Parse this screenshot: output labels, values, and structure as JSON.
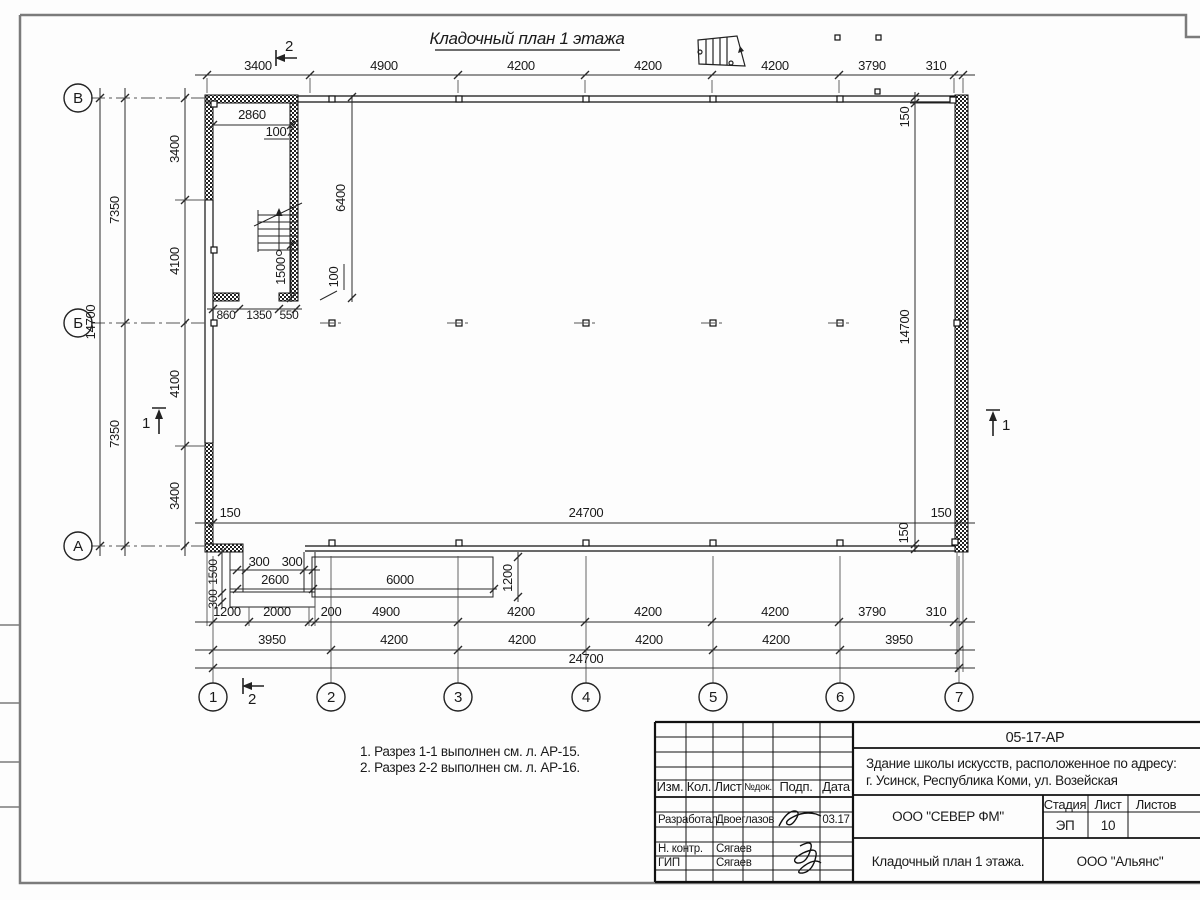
{
  "plan": {
    "title": "Кладочный план 1 этажа",
    "dims_top": [
      "3400",
      "4900",
      "4200",
      "4200",
      "4200",
      "3790",
      "310"
    ],
    "dims_left": {
      "total": "14700",
      "halves": [
        "7350",
        "7350"
      ],
      "inner": [
        "3400",
        "4100",
        "4100",
        "3400"
      ]
    },
    "dims_right": {
      "top150": "150",
      "total": "14700",
      "bot150": "150"
    },
    "dims_inner_bottom": {
      "left150": "150",
      "total": "24700",
      "right150": "150"
    },
    "stair_room": {
      "width": "2860",
      "wall_top": "100",
      "height": "6400",
      "run": "1500",
      "wall_bot": "100",
      "chain": [
        "860",
        "1350",
        "550"
      ]
    },
    "porch": {
      "step_a": "300",
      "step_b": "300",
      "width_small": "2600",
      "width_long": "6000",
      "depth": "1200",
      "v_run": "1500",
      "v_step": "300"
    },
    "dims_b1": [
      "1200",
      "2000",
      "200",
      "4900",
      "4200",
      "4200",
      "4200",
      "3790",
      "310"
    ],
    "dims_b2": [
      "3950",
      "4200",
      "4200",
      "4200",
      "4200",
      "3950"
    ],
    "dims_b3": "24700",
    "axes_v": [
      "1",
      "2",
      "3",
      "4",
      "5",
      "6",
      "7"
    ],
    "axes_h": [
      "В",
      "Б",
      "А"
    ],
    "section1": "1",
    "section2": "2"
  },
  "notes": {
    "line1": "1. Разрез 1-1 выполнен см. л. АР-15.",
    "line2": "2. Разрез 2-2 выполнен см. л. АР-16."
  },
  "titleblock": {
    "doc_code": "05-17-АР",
    "project_line1": "Здание школы искусств, расположенное по адресу:",
    "project_line2": "г. Усинск, Республика Коми, ул. Возейская",
    "org_main": "ООО \"СЕВЕР ФМ\"",
    "org_secondary": "ООО \"Альянс\"",
    "sheet_title": "Кладочный план 1 этажа.",
    "cols": {
      "izm": "Изм.",
      "kol": "Кол.",
      "list": "Лист",
      "ndok": "№док.",
      "podp": "Подп.",
      "data": "Дата"
    },
    "stage_label": "Стадия",
    "sheet_label": "Лист",
    "sheets_label": "Листов",
    "stage_value": "ЭП",
    "sheet_value": "10",
    "rows": [
      {
        "role": "Разработал",
        "name": "Двоеглазов",
        "date": "03.17"
      },
      {
        "role": "Н. контр.",
        "name": "Сягаев",
        "date": ""
      },
      {
        "role": "ГИП",
        "name": "Сягаев",
        "date": ""
      }
    ]
  }
}
